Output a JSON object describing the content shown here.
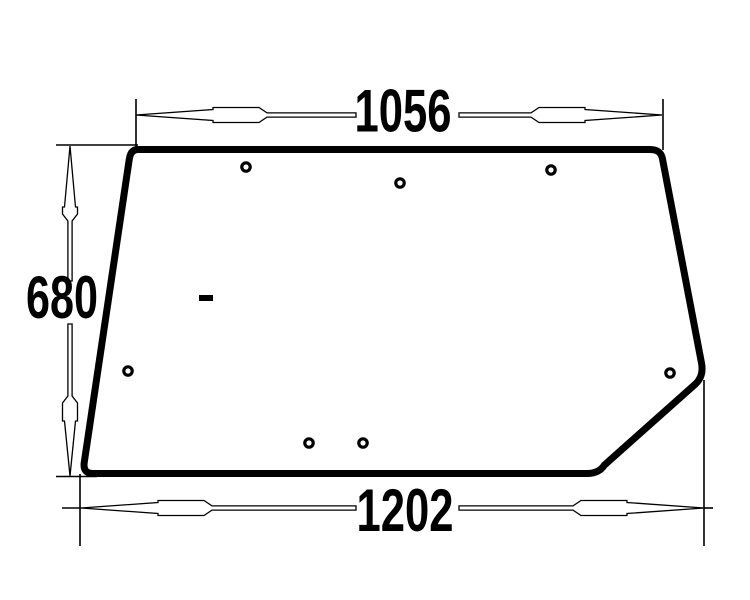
{
  "drawing": {
    "background": "#ffffff",
    "ink": "#000000",
    "outline_stroke": 7,
    "thin_stroke": 1.6,
    "hole_radius": 4.2,
    "hole_stroke": 3.2
  },
  "dimensions": {
    "top_width": {
      "value": "1056"
    },
    "left_height": {
      "value": "680"
    },
    "bottom_width": {
      "value": "1202"
    }
  },
  "holes": [
    {
      "cx": 246,
      "cy": 167
    },
    {
      "cx": 400,
      "cy": 183
    },
    {
      "cx": 551,
      "cy": 170
    },
    {
      "cx": 128,
      "cy": 371
    },
    {
      "cx": 670,
      "cy": 373
    },
    {
      "cx": 309,
      "cy": 443
    },
    {
      "cx": 363,
      "cy": 443
    }
  ]
}
